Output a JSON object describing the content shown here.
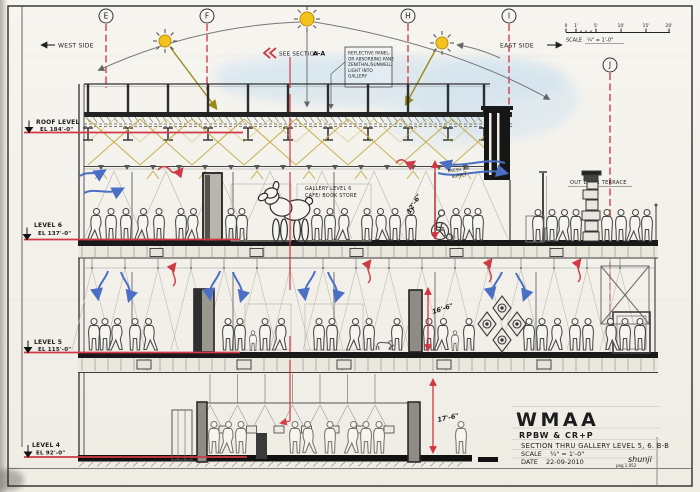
{
  "sheet_labels": {
    "west": "WEST SIDE",
    "east": "EAST SIDE",
    "see_section": "SEE SECTION",
    "section_ref": "A-A",
    "gallery_line1": "GALLERY   LEVEL 6",
    "gallery_line2": "CAFE/ BOOK STORE",
    "terrace": "OUT DOOR TERRACE",
    "fresh_air_line1": "FRESH AIR",
    "fresh_air_line2": "SUPPLY"
  },
  "note_box": {
    "lines": [
      "REFLECTIVE PANEL-",
      "OR ABSORBING PANE",
      "ZENITHAL/SUNWELL",
      "LIGHT INTO",
      "GALLERY"
    ]
  },
  "grid_bubbles": [
    {
      "label": "E"
    },
    {
      "label": "F"
    },
    {
      "label": "H"
    },
    {
      "label": "I"
    },
    {
      "label": "J"
    }
  ],
  "scale_bar": {
    "ticks": [
      "0",
      "1'",
      "5'",
      "10'",
      "15'",
      "20'"
    ],
    "label": "SCALE",
    "value": "¼\" = 1'-0\""
  },
  "levels": [
    {
      "name": "ROOF LEVEL",
      "elevation": "EL 184'-0\""
    },
    {
      "name": "LEVEL 6",
      "elevation": "EL 137'-0\""
    },
    {
      "name": "LEVEL 5",
      "elevation": "EL 115'-0\""
    },
    {
      "name": "LEVEL 4",
      "elevation": "EL 92'-0\""
    }
  ],
  "dimensions": [
    {
      "value": "12'-6\""
    },
    {
      "value": "16'-6\""
    },
    {
      "value": "17'-6\""
    }
  ],
  "title_block": {
    "project": "WMAA",
    "architects": "RPBW  &  CR+P",
    "drawing_title": "SECTION THRU GALLERY  LEVEL 5, 6.   B-B",
    "scale_label": "SCALE",
    "scale_value": "¼\" = 1'-0\"",
    "date_label": "DATE",
    "date_value": "22-09-2010",
    "signature": "shunji",
    "sheet_ref": "pag 1.052"
  },
  "colors": {
    "grid_red": "#cf3a45",
    "dim_red": "#d23540",
    "pen_blue": "#4a6fc4",
    "sun_yellow": "#f4c21c",
    "light_olive": "#9a8a1c",
    "paper": "#f6f4ee"
  }
}
